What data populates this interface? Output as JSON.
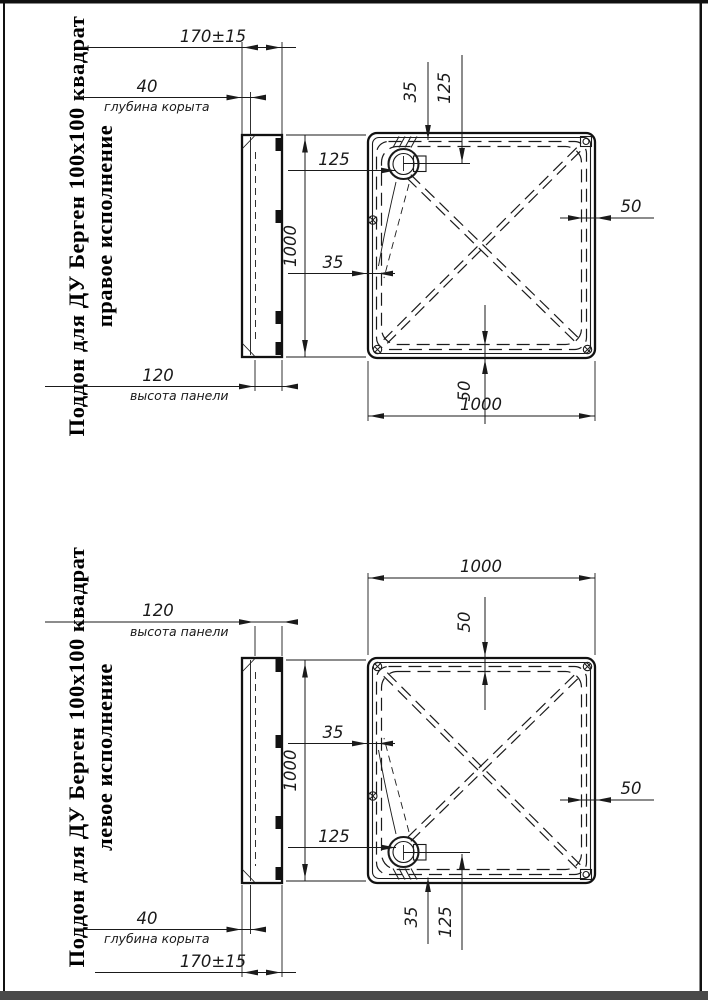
{
  "frame": {
    "line_color": "#111111",
    "shadow_color": "#4a4a4a"
  },
  "drawing_right": {
    "title_line1": "Поддон для ДУ Берген 100x100 квадрат",
    "title_line2": "правое исполнение",
    "dims": {
      "width_overall": "170±15",
      "bowl_depth": "40",
      "bowl_depth_label": "глубина корыта",
      "panel_height": "120",
      "panel_height_label": "высота панели",
      "side_v": "1000",
      "side_h": "1000",
      "drain_offset_h": "125",
      "drain_offset_v": "125",
      "rim_h": "35",
      "rim_v": "35",
      "rim_right": "50",
      "rim_edge": "50"
    }
  },
  "drawing_left": {
    "title_line1": "Поддон для ДУ Берген 100x100 квадрат",
    "title_line2": "левое исполнение",
    "dims": {
      "width_overall": "170±15",
      "bowl_depth": "40",
      "bowl_depth_label": "глубина корыта",
      "panel_height": "120",
      "panel_height_label": "высота панели",
      "side_v": "1000",
      "side_h": "1000",
      "drain_offset_h": "125",
      "drain_offset_v": "125",
      "rim_h": "35",
      "rim_v": "35",
      "rim_right": "50",
      "rim_edge": "50"
    }
  }
}
